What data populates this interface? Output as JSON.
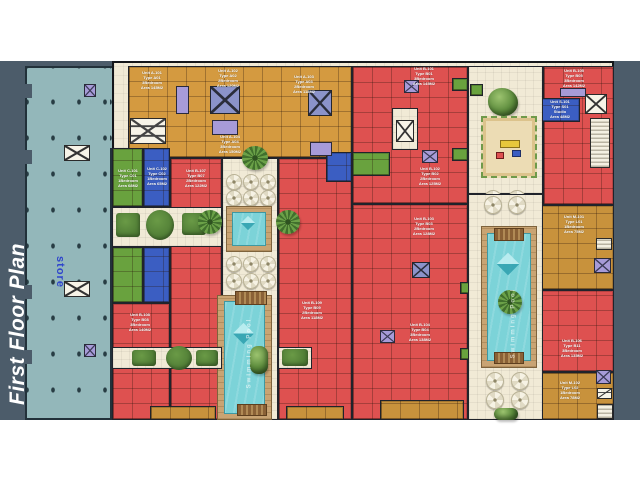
{
  "title": "First Floor Plan",
  "store": {
    "label": "store"
  },
  "pools": {
    "river_label": "Swimming Pool",
    "right_label": "Swimming Pool"
  },
  "colors": {
    "slate": "#4c5c6a",
    "store": "#93b7ba",
    "cream": "#f1ead6",
    "red": "#de5150",
    "orange": "#d49a40",
    "gold": "#c8923c",
    "green": "#69a23e",
    "blue": "#3b5ec2",
    "lavender": "#a79bd8",
    "deck": "#c9a473",
    "pool": "#7cd3d8"
  },
  "units": [
    {
      "label": "Unit A-101\nType A01\n3Bedroom\nArea 145M2"
    },
    {
      "label": "Unit A-102\nType A02\n2Bedroom\nArea 120M2"
    },
    {
      "label": "Unit A-103\nType A03\n2Bedroom\nArea 118M2"
    },
    {
      "label": "Unit A-104\nType A04\n3Bedroom\nArea 150M2"
    },
    {
      "label": "Unit B-101\nType B01\n3Bedroom\nArea 145M2"
    },
    {
      "label": "Unit B-102\nType B02\n2Bedroom\nArea 125M2"
    },
    {
      "label": "Unit B-103\nType B03\n2Bedroom\nArea 128M2"
    },
    {
      "label": "Unit B-104\nType B04\n3Bedroom\nArea 138M2"
    },
    {
      "label": "Unit B-105\nType B05\n3Bedroom\nArea 142M2"
    },
    {
      "label": "Unit S-101\nType S01\nStudio\nArea 48M2"
    },
    {
      "label": "Unit M-101\nType L01\n1Bedroom\nArea 75M2"
    },
    {
      "label": "Unit B-106\nType B11\n3Bedroom\nArea 135M2"
    },
    {
      "label": "Unit M-102\nType L02\n1Bedroom\nArea 78M2"
    },
    {
      "label": "Unit C-101\nType C01\n1Bedroom\nArea 68M2"
    },
    {
      "label": "Unit C-102\nType C02\n1Bedroom\nArea 65M2"
    },
    {
      "label": "Unit B-107\nType B07\n2Bedroom\nArea 122M2"
    },
    {
      "label": "Unit B-108\nType B08\n3Bedroom\nArea 140M2"
    },
    {
      "label": "Unit B-109\nType B09\n2Bedroom\nArea 118M2"
    }
  ]
}
